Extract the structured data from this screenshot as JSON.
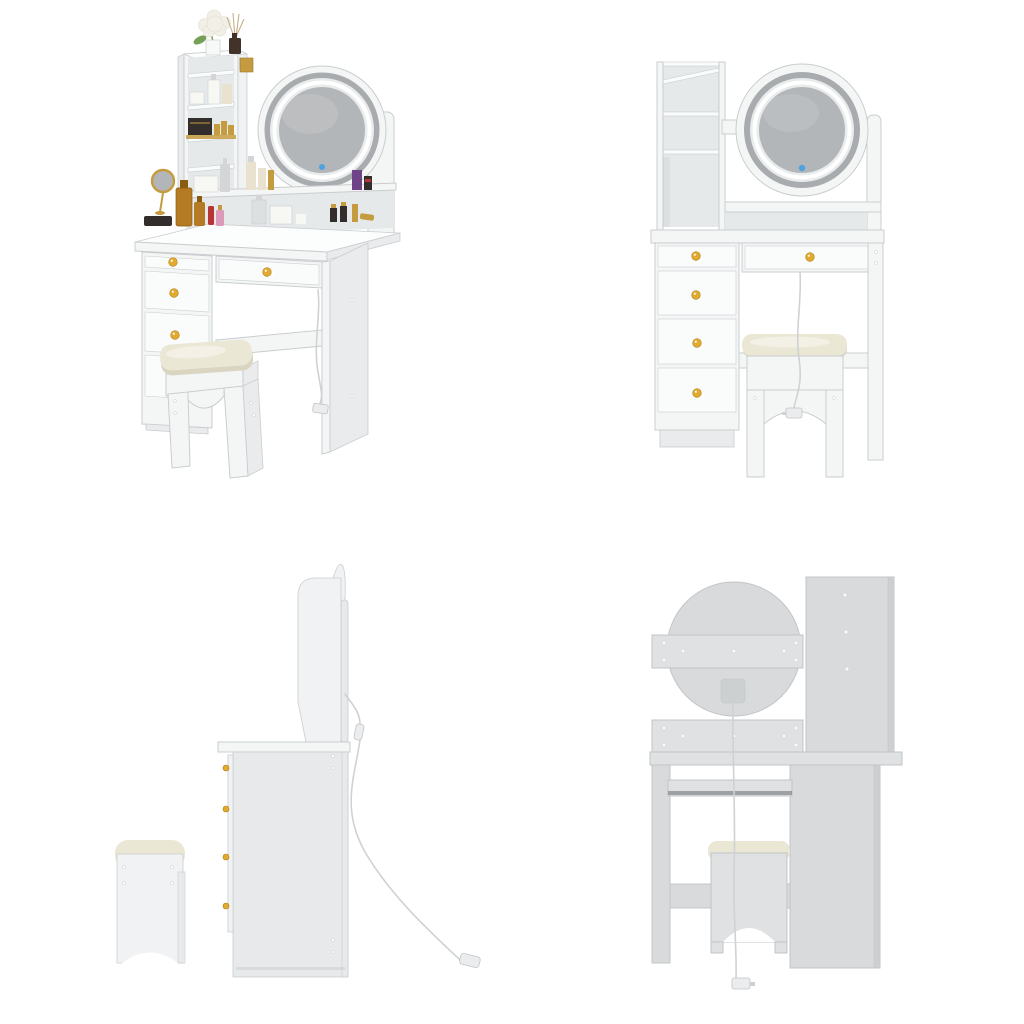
{
  "page": {
    "background": "#ffffff",
    "kind": "product-image-gallery",
    "grid": "2x2"
  },
  "views": [
    {
      "id": "front-three-quarter",
      "label": "Vanity desk with LED mirror, storage shelves, drawers and cushioned stool, decorated with cosmetics - front three-quarter view"
    },
    {
      "id": "front",
      "label": "Vanity desk with round LED mirror, shelf tower, five drawers with gold knobs, stool and power cord - front view"
    },
    {
      "id": "side",
      "label": "Vanity desk and stool - side profile view with power cord and plug"
    },
    {
      "id": "back",
      "label": "Vanity desk - back view showing mirror back panel, junction box, power cord and plug"
    }
  ],
  "colors": {
    "furn_front": "#f4f6f6",
    "furn_front_bright": "#fafbfb",
    "furn_side": "#e9ebec",
    "furn_top": "#fcfdfd",
    "furn_edge": "#c9cdcf",
    "interior_shadow": "#e6e9ea",
    "interior_deep": "#dde0e1",
    "mirror_ring": "#a9acae",
    "mirror_glass": "#b3b6b8",
    "mirror_glass_hi": "#c3c5c7",
    "led_white": "#ffffff",
    "led_glow": "#e9ecec",
    "touch_blue": "#4da3e0",
    "knob_gold": "#e2aa2e",
    "knob_gold_deep": "#b07f16",
    "cushion_cream": "#ebe7d5",
    "cushion_shade": "#d9d5c1",
    "cushion_hi": "#f6f3e9",
    "back_panel": "#d8dadb",
    "back_panel_light": "#dfe1e2",
    "back_panel_dark": "#cdd0d1",
    "back_edge": "#c2c5c7",
    "rail_line_dark": "#8d9193",
    "screw_white": "#fafbfb",
    "cord_gray": "#cfd2d4",
    "plug_body": "#eaeced",
    "side_body": "#e7e9ea",
    "side_light": "#f0f2f3",
    "decor_green": "#76a058",
    "decor_flower": "#f2f0e6",
    "decor_flower_edge": "#e0ddd0",
    "decor_vase": "#f7f8f8",
    "decor_diffuser": "#41332a",
    "decor_stick": "#c6b088",
    "decor_gold": "#c59b3f",
    "decor_gold_deep": "#9a7835",
    "decor_amber": "#b57b24",
    "decor_amber_deep": "#8a5c12",
    "decor_dark": "#332e2b",
    "decor_red": "#b73535",
    "decor_pink": "#dd9ab8",
    "decor_purple": "#6f4388",
    "decor_white": "#f7f7f4",
    "decor_gray": "#d3d5d6",
    "decor_cream": "#e8e2cf"
  }
}
